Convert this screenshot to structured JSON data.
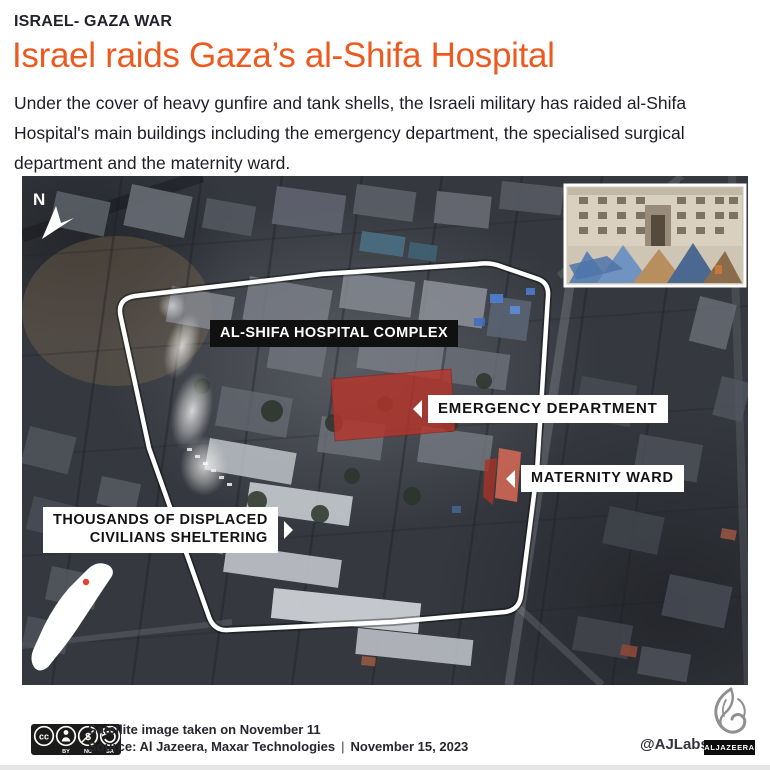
{
  "theme": {
    "accent_orange": "#ed5a20",
    "ink": "#23232d",
    "highlight_red": "#b8352b",
    "map_outline_color": "#ffffff"
  },
  "header": {
    "eyebrow": "ISRAEL- GAZA WAR",
    "title": "Israel raids Gaza’s al-Shifa Hospital",
    "description": "Under the cover of heavy gunfire and tank shells, the Israeli military has raided al-Shifa Hospital's main buildings including the emergency department, the specialised surgical department and the maternity ward."
  },
  "map": {
    "compass": "N",
    "labels": {
      "complex": "AL-SHIFA HOSPITAL COMPLEX",
      "emergency": "EMERGENCY DEPARTMENT",
      "maternity": "MATERNITY WARD",
      "civilians_line1": "THOUSANDS OF DISPLACED",
      "civilians_line2": "CIVILIANS SHELTERING"
    },
    "icons": {
      "north_arrow": "north-arrow",
      "gaza_locator": "gaza-strip-locator",
      "inset": "hospital-photo-inset"
    }
  },
  "footer": {
    "license": {
      "cc": "cc",
      "nc_glyph": "$",
      "by": "BY",
      "nc": "NC",
      "sa": "SA"
    },
    "caption": "Satellite image taken on November 11",
    "source": "Source: Al Jazeera, Maxar Technologies",
    "separator": "|",
    "date": "November 15, 2023",
    "handle": "@AJLabs",
    "logo_text": "ALJAZEERA"
  }
}
